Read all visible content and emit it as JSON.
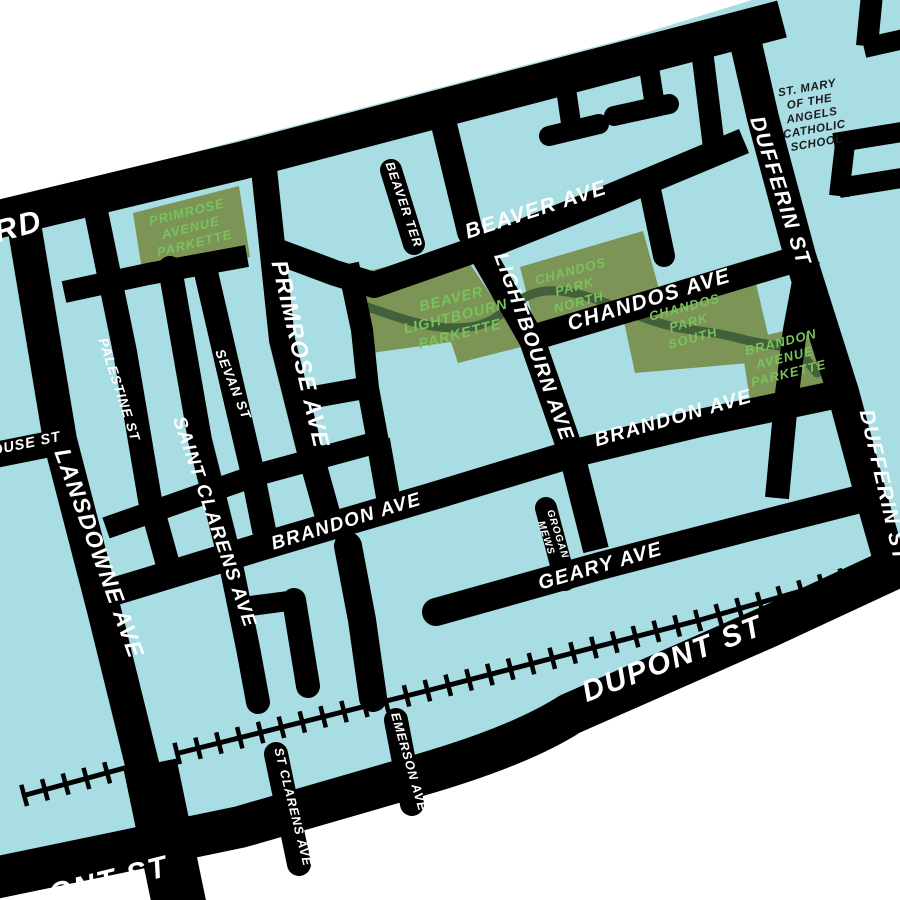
{
  "map": {
    "colors": {
      "land": "#A8DDE3",
      "outside": "#FFFFFF",
      "road": "#000000",
      "road_label": "#FFFFFF",
      "park": "#7D9457",
      "park_label": "#79C35C",
      "trail": "#42613A",
      "poi_label": "#1A1A1A"
    },
    "street_labels": {
      "rd_partial": "RD",
      "ouse_partial": "OUSE ST",
      "dupont_partial": "ONT ST",
      "palestine": "PALESTINE ST",
      "sevan": "SEVAN ST",
      "saint_clarens_north": "SAINT CLARENS AVE",
      "saint_clarens_south": "ST CLARENS AVE",
      "primrose": "PRIMROSE AVE",
      "lansdowne": "LANSDOWNE AVE",
      "beaver_ter": "BEAVER TER",
      "beaver_ave": "BEAVER AVE",
      "lightbourn": "LIGHTBOURN AVE",
      "chandos": "CHANDOS AVE",
      "brandon": "BRANDON AVE",
      "geary": "GEARY AVE",
      "grogan_line1": "GROGAN",
      "grogan_line2": "MEWS",
      "dupont": "DUPONT ST",
      "dufferin": "DUFFERIN ST",
      "emerson": "EMERSON AVE"
    },
    "parks": {
      "primrose_parkette": {
        "lines": [
          "PRIMROSE",
          "AVENUE",
          "PARKETTE"
        ]
      },
      "beaver_lightbourn_parkette": {
        "lines": [
          "BEAVER",
          "LIGHTBOURN",
          "PARKETTE"
        ]
      },
      "chandos_park_north": {
        "lines": [
          "CHANDOS",
          "PARK",
          "NORTH"
        ]
      },
      "chandos_park_south": {
        "lines": [
          "CHANDOS",
          "PARK",
          "SOUTH"
        ]
      },
      "brandon_avenue_parkette": {
        "lines": [
          "BRANDON",
          "AVENUE",
          "PARKETTE"
        ]
      }
    },
    "pois": {
      "school": {
        "lines": [
          "ST. MARY",
          "OF THE",
          "ANGELS",
          "CATHOLIC",
          "SCHOOL"
        ]
      }
    }
  }
}
